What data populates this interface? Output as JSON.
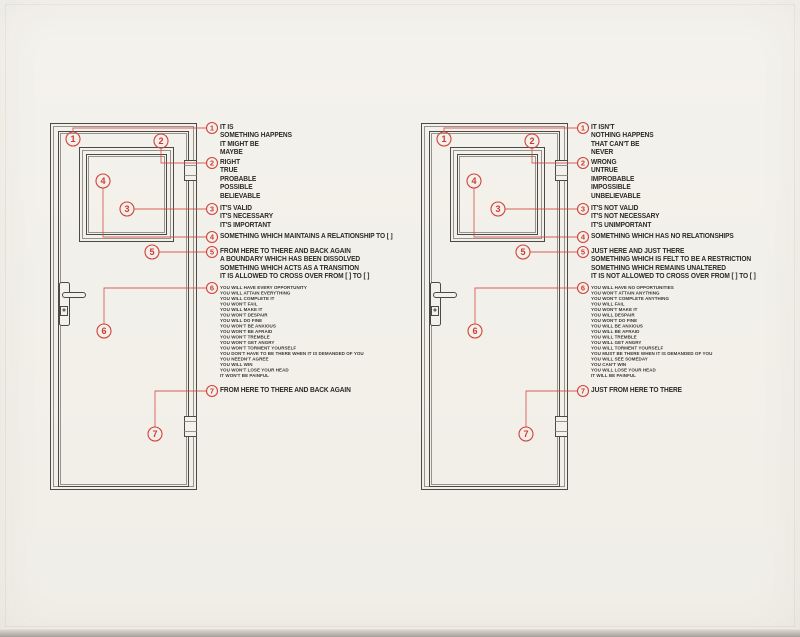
{
  "colors": {
    "paper": "#f3f1ea",
    "accent_red": "#cf3a32",
    "ink": "#2c2a27"
  },
  "panels": [
    {
      "id": "left",
      "annotations": [
        {
          "num": "1",
          "lines": [
            "IT IS",
            "SOMETHING HAPPENS",
            "IT MIGHT BE",
            "MAYBE"
          ]
        },
        {
          "num": "2",
          "lines": [
            "RIGHT",
            "TRUE",
            "PROBABLE",
            "POSSIBLE",
            "BELIEVABLE"
          ]
        },
        {
          "num": "3",
          "lines": [
            "IT'S VALID",
            "IT'S NECESSARY",
            "IT'S IMPORTANT"
          ]
        },
        {
          "num": "4",
          "lines": [
            "SOMETHING WHICH MAINTAINS A RELATIONSHIP TO [ ]"
          ]
        },
        {
          "num": "5",
          "lines": [
            "FROM HERE TO THERE AND BACK AGAIN",
            "A BOUNDARY WHICH HAS BEEN DISSOLVED",
            "SOMETHING WHICH ACTS AS A TRANSITION",
            "IT IS ALLOWED TO CROSS OVER FROM [ ] TO [ ]"
          ]
        },
        {
          "num": "6",
          "lines": [
            "YOU WILL HAVE EVERY OPPORTUNITY",
            "YOU WILL ATTAIN EVERYTHING",
            "YOU WILL COMPLETE IT",
            "YOU WON'T FAIL",
            "YOU WILL MAKE IT",
            "YOU WON'T DESPAIR",
            "YOU WILL DO FINE",
            "YOU WON'T BE ANXIOUS",
            "YOU WON'T BE AFRAID",
            "YOU WON'T TREMBLE",
            "YOU WON'T GET ANGRY",
            "YOU WON'T TORMENT YOURSELF",
            "YOU DON'T HAVE TO BE THERE WHEN IT IS DEMANDED OF YOU",
            "YOU NEEDN'T AGREE",
            "YOU WILL WIN",
            "YOU WON'T LOSE YOUR HEAD",
            "IT WON'T BE PAINFUL"
          ]
        },
        {
          "num": "7",
          "lines": [
            "FROM HERE TO THERE AND BACK AGAIN"
          ]
        }
      ]
    },
    {
      "id": "right",
      "annotations": [
        {
          "num": "1",
          "lines": [
            "IT ISN'T",
            "NOTHING HAPPENS",
            "THAT CAN'T BE",
            "NEVER"
          ]
        },
        {
          "num": "2",
          "lines": [
            "WRONG",
            "UNTRUE",
            "IMPROBABLE",
            "IMPOSSIBLE",
            "UNBELIEVABLE"
          ]
        },
        {
          "num": "3",
          "lines": [
            "IT'S NOT VALID",
            "IT'S NOT NECESSARY",
            "IT'S UNIMPORTANT"
          ]
        },
        {
          "num": "4",
          "lines": [
            "SOMETHING WHICH HAS NO RELATIONSHIPS"
          ]
        },
        {
          "num": "5",
          "lines": [
            "JUST HERE AND JUST THERE",
            "SOMETHING WHICH IS FELT TO BE A RESTRICTION",
            "SOMETHING WHICH REMAINS UNALTERED",
            "IT IS NOT ALLOWED TO CROSS OVER FROM [ ] TO [ ]"
          ]
        },
        {
          "num": "6",
          "lines": [
            "YOU WILL HAVE NO OPPORTUNITIES",
            "YOU WON'T ATTAIN ANYTHING",
            "YOU WON'T COMPLETE ANYTHING",
            "YOU WILL FAIL",
            "YOU WON'T MAKE IT",
            "YOU WILL DESPAIR",
            "YOU WON'T DO FINE",
            "YOU WILL BE ANXIOUS",
            "YOU WILL BE AFRAID",
            "YOU WILL TREMBLE",
            "YOU WILL GET ANGRY",
            "YOU WILL TORMENT YOURSELF",
            "YOU MUST BE THERE WHEN IT IS DEMANDED OF YOU",
            "YOU WILL SEE SOMEDAY",
            "YOU CAN'T WIN",
            "YOU WILL LOSE YOUR HEAD",
            "IT WILL BE PAINFUL"
          ]
        },
        {
          "num": "7",
          "lines": [
            "JUST FROM HERE TO THERE"
          ]
        }
      ]
    }
  ]
}
